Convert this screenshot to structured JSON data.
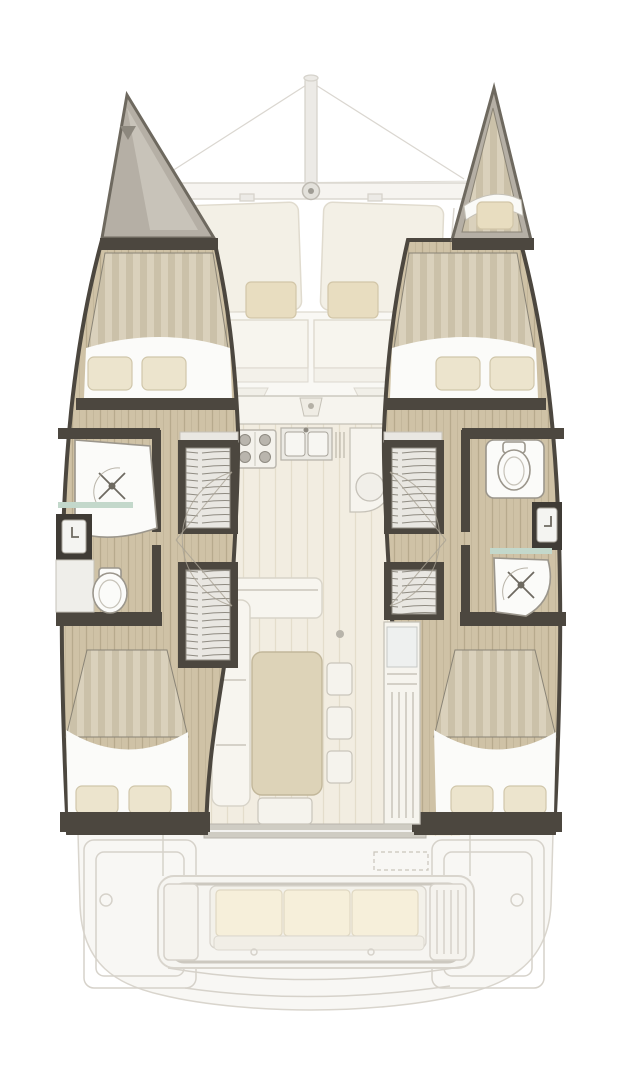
{
  "diagram": {
    "type": "floor-plan",
    "subject": "catamaran sailing yacht interior layout",
    "view": "top-down, bow up",
    "visible_text": []
  },
  "palette": {
    "background": "#ffffff",
    "wall_dark": "#4c473f",
    "wood": "#cfc2a6",
    "wood_line": "#b7aa8d",
    "duvet": "#dad1bc",
    "duvet_stripe": "#cbc1a9",
    "pillow": "#ece4cd",
    "fixture_white": "#fbfbf9",
    "outline_gray": "#9b968c",
    "ghost_fill": "#f5f3ee",
    "ghost_line": "#d6d2ca",
    "cushion_tan": "#e8ddc0",
    "counter_white": "#f6f4ee",
    "table_beige": "#ddd3b8",
    "glass_teal": "#c3d8cb",
    "forepeak_gray": "#b5afa5",
    "saloon_floor": "#f2ede1",
    "saloon_plank": "#e4ddcb"
  },
  "vessel": {
    "foredeck": {
      "features": [
        "bowsprit-pole",
        "rigging-lines",
        "cross-beam",
        "center-fitting",
        "two-trampoline-panels"
      ]
    },
    "forward_cockpit": {
      "features": [
        "two-bench-seats",
        "two-backrest-cushions",
        "center-steps"
      ]
    },
    "port_hull": {
      "bow_locker": "gray triangular forepeak",
      "forward_cabin": {
        "berth": "double",
        "pillows": 2,
        "bedding": "striped duvet"
      },
      "bathroom": {
        "fixtures": [
          "shower-stall",
          "washbasin-vanity",
          "toilet"
        ],
        "glass_partition": true
      },
      "companionway_stairs": 2,
      "aft_cabin": {
        "berth": "double",
        "pillows": 2,
        "bedding": "striped duvet"
      }
    },
    "starboard_hull": {
      "bow_cabin": {
        "berth": "single forepeak berth",
        "cushions": 1
      },
      "forward_cabin": {
        "berth": "double",
        "pillows": 2,
        "bedding": "striped duvet"
      },
      "bathroom": {
        "fixtures": [
          "toilet",
          "washbasin-vanity",
          "shower-stall"
        ],
        "glass_partition": true
      },
      "companionway_stairs": 2,
      "aft_cabin": {
        "berth": "double",
        "pillows": 2,
        "bedding": "striped duvet"
      }
    },
    "saloon": {
      "galley": [
        "four-burner-stove",
        "double-sink",
        "drainer",
        "rounded-counter-with-basin"
      ],
      "dinette": [
        "l-shaped-sofa",
        "rectangular-table",
        "three-stools",
        "one-stool"
      ],
      "cabinet": "tall unit with louvred front"
    },
    "aft_deck": {
      "features": [
        "cockpit-rail-frame",
        "three-cushion-bench",
        "side-module-left",
        "louvred-module-right",
        "two-deck-hatches",
        "dashed-locker-outline",
        "transom-steps"
      ]
    }
  },
  "icons": [
    "shower-head-icon",
    "faucet-icon",
    "toilet-icon",
    "stove-burner-icon",
    "sink-basin-icon",
    "door-swing-arc-icon",
    "mast-fitting-icon"
  ]
}
